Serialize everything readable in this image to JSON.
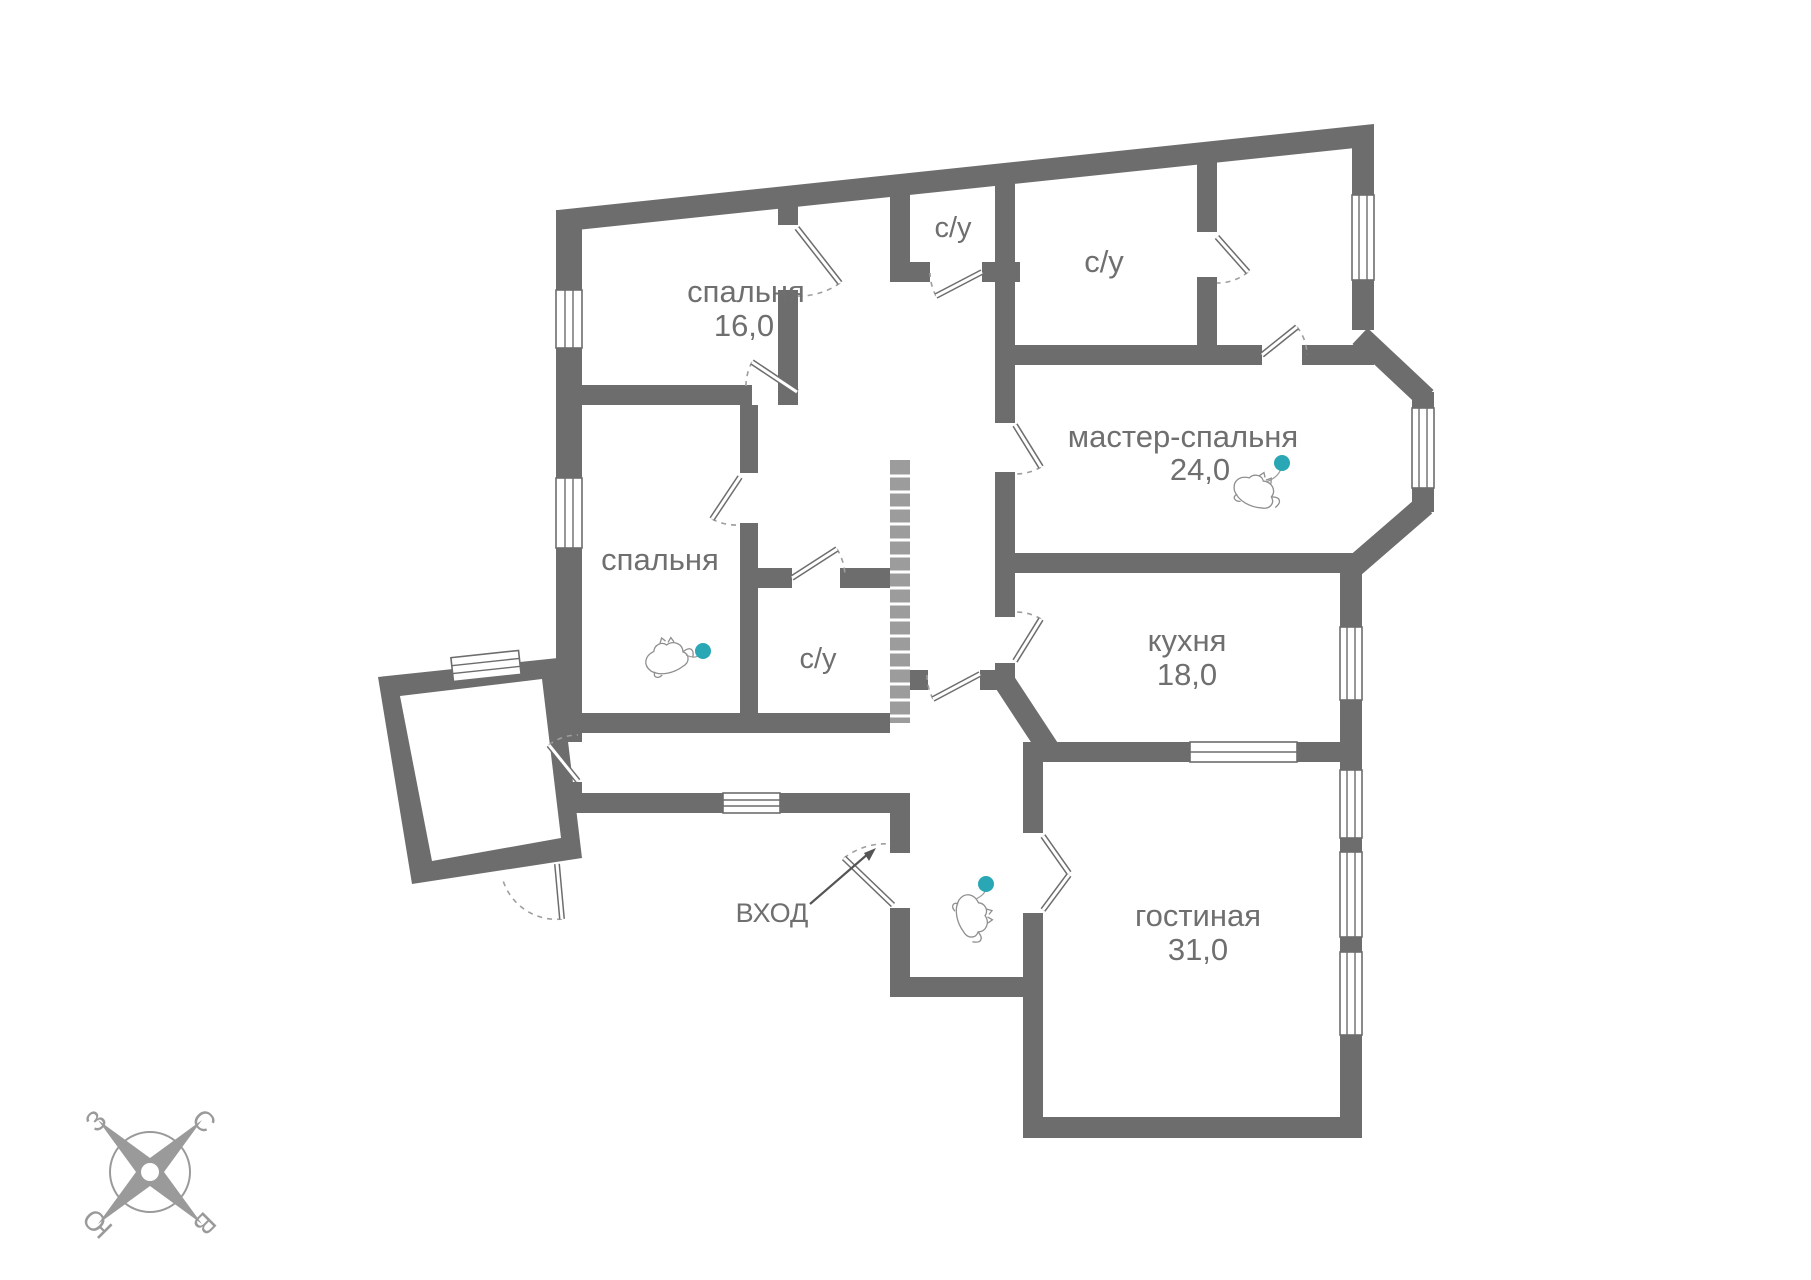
{
  "plan": {
    "rooms": {
      "bedroom1": {
        "label": "спальня",
        "area": "16,0"
      },
      "bedroom2": {
        "label": "спальня"
      },
      "bathroom_top": {
        "label": "с/у"
      },
      "bathroom_big": {
        "label": "с/у"
      },
      "bathroom_small": {
        "label": "с/у"
      },
      "master_bedroom": {
        "label": "мастер-спальня",
        "area": "24,0"
      },
      "kitchen": {
        "label": "кухня",
        "area": "18,0"
      },
      "living_room": {
        "label": "гостиная",
        "area": "31,0"
      }
    },
    "entrance": {
      "label": "ВХОД"
    },
    "compass": {
      "north": "С",
      "south": "Ю",
      "west": "З",
      "east": "В"
    },
    "colors": {
      "wall": "#6d6d6d",
      "text": "#6f6f6f",
      "toy_dot": "#2aa7b5",
      "compass": "#9a9a9a"
    }
  }
}
